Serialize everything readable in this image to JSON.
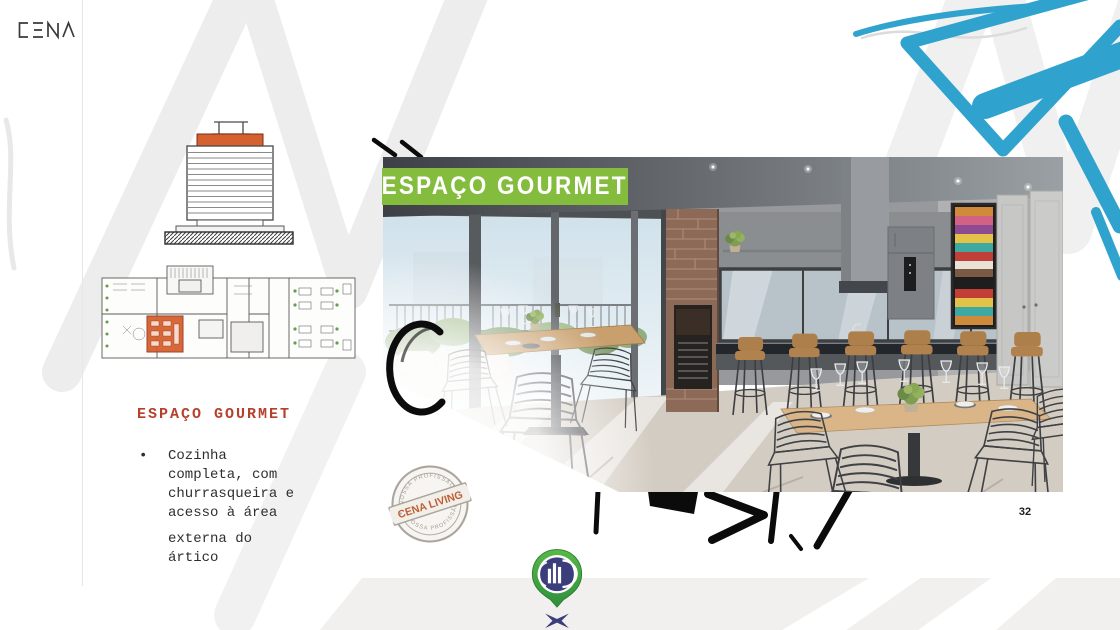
{
  "slide": {
    "page_number": "32"
  },
  "brand": {
    "logo_text": "CENA"
  },
  "banner": {
    "label": "ESPAÇO GOURMET"
  },
  "content": {
    "heading": "ESPAÇO GOURMET",
    "bullet_paragraphs": [
      "Cozinha completa, com churrasqueira e acesso à área",
      "externa do ártico"
    ]
  },
  "stamp": {
    "arc_top": "NOSSA PROFISSÃO",
    "label": "CENA LIVING",
    "arc_bottom": "NOSSA PROFISSÃO"
  },
  "colors": {
    "banner_green": "#84bd3e",
    "heading_red": "#b5402c",
    "brush_blue": "#2aa0cd",
    "plan_highlight_orange": "#d4612f",
    "pin_green": "#4fb24a",
    "pin_navy": "#3b3e7a",
    "stamp_orange": "#bf5f36"
  }
}
